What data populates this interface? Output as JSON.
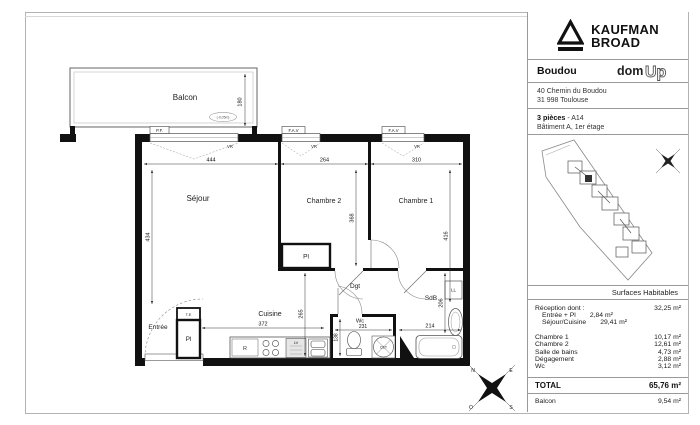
{
  "title_block": {
    "brand_line1": "KAUFMAN",
    "brand_line2": "BROAD",
    "project_name": "Boudou",
    "logo_dom": "dom",
    "logo_up": "Up",
    "address_line1": "40 Chemin du Boudou",
    "address_line2": "31 998  Toulouse",
    "unit_type": "3 pièces",
    "unit_sep": "-",
    "unit_ref": "A14",
    "unit_location": "Bâtiment A, 1er étage",
    "surfaces": {
      "header": "Surfaces Habitables",
      "reception": {
        "label": "Réception dont :",
        "value": "32,25 m²"
      },
      "reception_details": [
        {
          "label": "Entrée  + Pl",
          "value": "2,84 m²"
        },
        {
          "label": "Séjour/Cuisine",
          "value": "29,41 m²"
        }
      ],
      "rows": [
        {
          "label": "Chambre 1",
          "value": "10,17 m²"
        },
        {
          "label": "Chambre 2",
          "value": "12,61 m²"
        },
        {
          "label": "Salle de bains",
          "value": "4,73 m²"
        },
        {
          "label": "Dégagement",
          "value": "2,88 m²"
        },
        {
          "label": "Wc",
          "value": "3,12 m²"
        }
      ],
      "total": {
        "label": "TOTAL",
        "value": "65,76 m²"
      },
      "balcony": {
        "label": "Balcon",
        "value": "9,54 m²"
      }
    }
  },
  "plan": {
    "rooms": {
      "balcon": "Balcon",
      "sejour": "Séjour",
      "chambre2": "Chambre 2",
      "chambre1": "Chambre 1",
      "cuisine": "Cuisine",
      "entree": "Entrée",
      "dgt": "Dgt",
      "sdb": "SdB",
      "wc": "Wc",
      "placard": "Pl",
      "te": "T.E"
    },
    "openings": {
      "pf": "P.F.",
      "fav": "F.A.V",
      "vr": "VR"
    },
    "fixtures": {
      "ll": "LL",
      "lv": "LV",
      "fridge": "R",
      "cet": "CET"
    },
    "level_stamp": "(-0,05m)",
    "dims": {
      "balcon_depth": "180",
      "sejour_w": "444",
      "chambre2_w": "264",
      "chambre1_w": "310",
      "sejour_h": "434",
      "chambre2_h": "368",
      "chambre1_h": "416",
      "cuisine_w": "372",
      "cuisine_h": "265",
      "wc_w": "231",
      "wc_h": "138",
      "sdb_w": "214",
      "sdb_h": "206"
    },
    "compass": {
      "n": "N",
      "e": "E",
      "s": "S",
      "o": "O"
    }
  }
}
